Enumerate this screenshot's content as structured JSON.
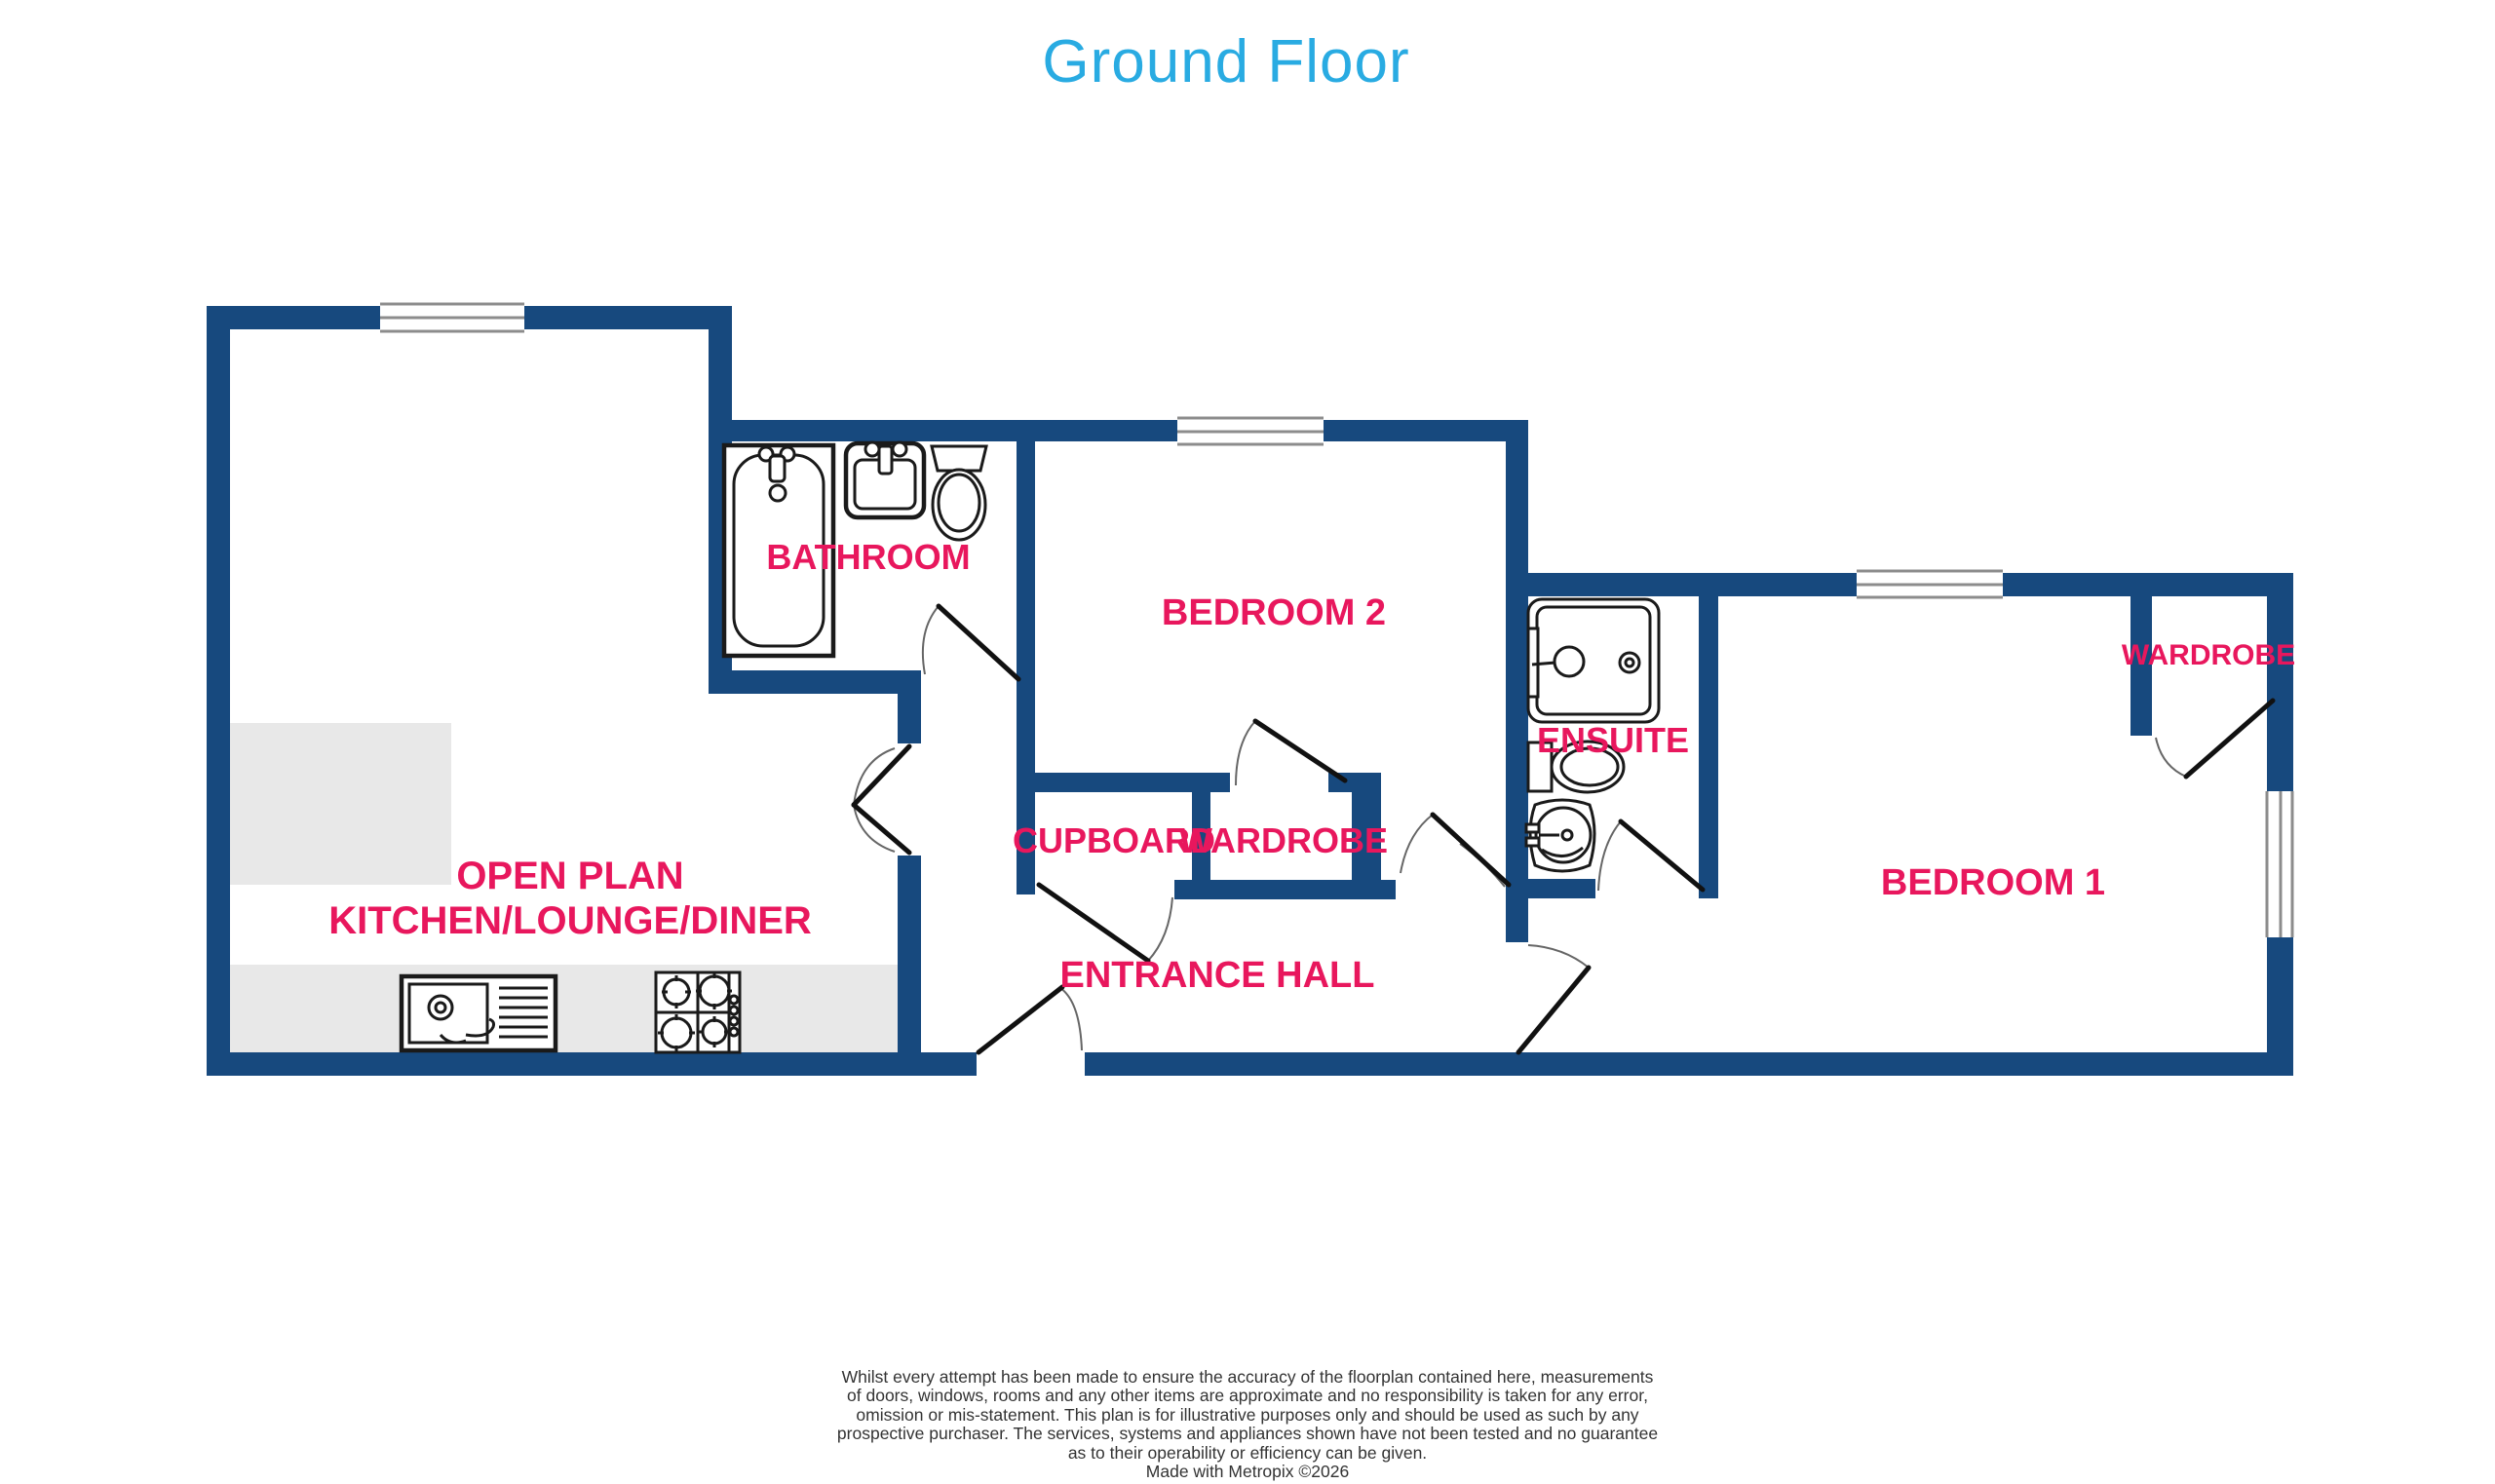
{
  "title": "Ground Floor",
  "colors": {
    "wall_navy": "#17497E",
    "label_pink": "#E8175D",
    "title_blue": "#29ABE2",
    "counter_gray": "#E8E8E8",
    "window_line": "#8C8C8C",
    "fixture_line": "#1A1A1A",
    "door_leaf": "#111111",
    "door_arc": "#666666",
    "disclaimer_text": "#333333"
  },
  "rooms": {
    "open_plan": {
      "label_line1": "OPEN PLAN",
      "label_line2": "KITCHEN/LOUNGE/DINER"
    },
    "bathroom": {
      "label": "BATHROOM"
    },
    "bedroom2": {
      "label": "BEDROOM 2"
    },
    "cupboard": {
      "label": "CUPBOARD"
    },
    "wardrobe_middle": {
      "label": "WARDROBE"
    },
    "ensuite": {
      "label": "ENSUITE"
    },
    "entrance_hall": {
      "label": "ENTRANCE HALL"
    },
    "bedroom1": {
      "label": "BEDROOM 1"
    },
    "wardrobe_bedroom1": {
      "label": "WARDROBE"
    }
  },
  "disclaimer": {
    "lines": [
      "Whilst every attempt has been made to ensure the accuracy of the floorplan contained here, measurements",
      "of doors, windows, rooms and any other items are approximate and no responsibility is taken for any error,",
      "omission or mis-statement. This plan is for illustrative purposes only and should be used as such by any",
      "prospective purchaser. The services, systems and appliances shown have not been tested and no guarantee",
      "as to their operability or efficiency can be given.",
      "Made with Metropix ©2026"
    ]
  }
}
